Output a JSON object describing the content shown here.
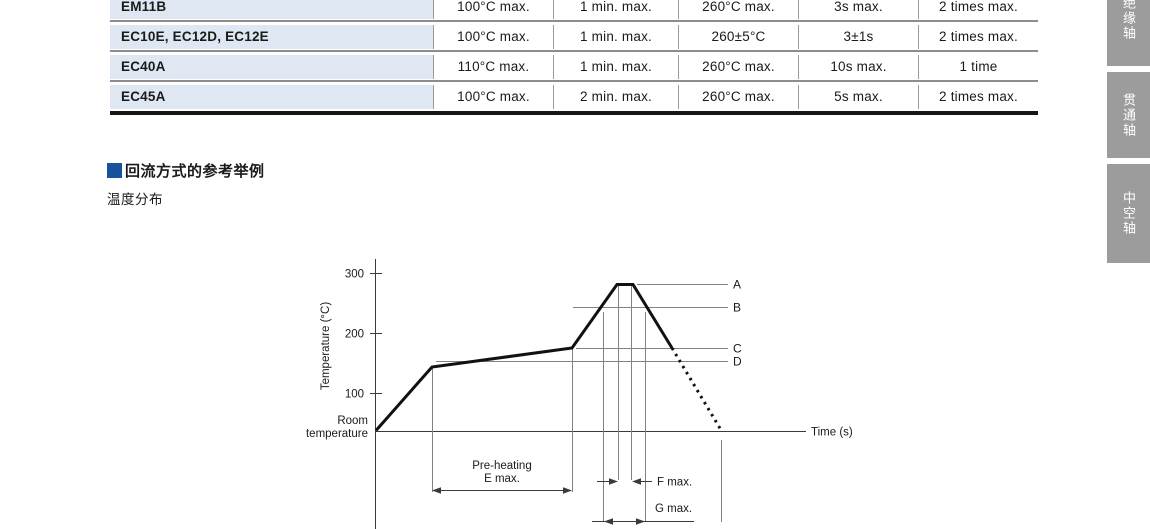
{
  "table": {
    "rows": [
      {
        "cells": [
          "EM11B",
          "100°C max.",
          "1 min. max.",
          "260°C max.",
          "3s max.",
          "2 times max."
        ]
      },
      {
        "cells": [
          "EC10E, EC12D, EC12E",
          "100°C max.",
          "1 min. max.",
          "260±5°C",
          "3±1s",
          "2 times max."
        ]
      },
      {
        "cells": [
          "EC40A",
          "110°C max.",
          "1 min. max.",
          "260°C max.",
          "10s max.",
          "1 time"
        ]
      },
      {
        "cells": [
          "EC45A",
          "100°C max.",
          "2 min. max.",
          "260°C max.",
          "5s max.",
          "2 times max."
        ]
      }
    ]
  },
  "section": {
    "title": "回流方式的参考举例",
    "subtitle": "温度分布"
  },
  "side_tabs": [
    {
      "label": "绝缘轴"
    },
    {
      "label": "贯通轴"
    },
    {
      "label": "中空轴"
    }
  ],
  "chart": {
    "y_axis_label": "Temperature (°C)",
    "ticks": [
      "300",
      "200",
      "100"
    ],
    "origin_label_line1": "Room",
    "origin_label_line2": "temperature",
    "x_axis_label": "Time (s)",
    "ref_label_a": "A",
    "ref_label_b": "B",
    "ref_label_c": "C",
    "ref_label_d": "D",
    "preheat_line1": "Pre-heating",
    "preheat_line2": "E max.",
    "f_label": "F max.",
    "g_label": "G max."
  },
  "chart_data": {
    "type": "line",
    "title": "温度分布 (reflow temperature profile)",
    "xlabel": "Time (s)",
    "ylabel": "Temperature (°C)",
    "yticks": [
      100,
      200,
      300
    ],
    "ylim": [
      25,
      320
    ],
    "x_axis_numbered": false,
    "series": [
      {
        "name": "reflow profile",
        "points": [
          {
            "t": 0,
            "temp_c": 30,
            "stage": "room temperature start"
          },
          {
            "t": 56,
            "temp_c": 150,
            "stage": "pre-heating start"
          },
          {
            "t": 196,
            "temp_c": 175,
            "stage": "pre-heating end (E max.)"
          },
          {
            "t": 241,
            "temp_c": 280,
            "stage": "peak start"
          },
          {
            "t": 257,
            "temp_c": 280,
            "stage": "peak end (F max.)"
          },
          {
            "t": 296,
            "temp_c": 175,
            "stage": "cooling, solid line ends"
          },
          {
            "t": 345,
            "temp_c": 30,
            "stage": "return to room temperature (dotted line)"
          }
        ],
        "note": "time axis carries no numbers; t values are relative units estimated from the drawing"
      }
    ],
    "reference_lines": [
      {
        "label": "A",
        "temp_c": 280
      },
      {
        "label": "B",
        "temp_c": 240
      },
      {
        "label": "C",
        "temp_c": 175
      },
      {
        "label": "D",
        "temp_c": 150
      }
    ],
    "annotations": [
      "Pre-heating E max.",
      "F max.",
      "G max.",
      "Room temperature"
    ],
    "legend": false,
    "grid": false
  }
}
